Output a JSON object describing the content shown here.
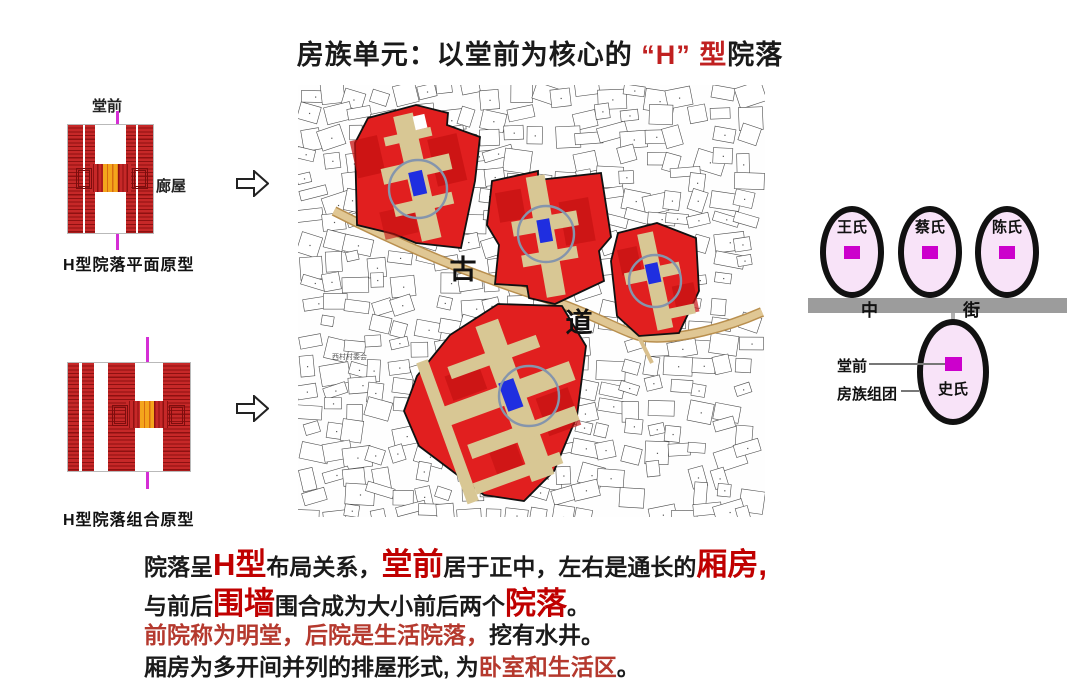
{
  "title": {
    "segments": [
      {
        "t": "房族单元：以堂前为核心的",
        "s": "base"
      },
      {
        "t": " “H” 型",
        "s": "tred"
      },
      {
        "t": "院落",
        "s": "base"
      }
    ]
  },
  "left_panel": {
    "hall_label": "堂前",
    "corridor_label": "廊屋",
    "caption_plan": "H型院落平面原型",
    "caption_combo": "H型院落组合原型"
  },
  "map": {
    "road_char_1": "古",
    "road_char_2": "道",
    "village_label": "西村村委会"
  },
  "right_panel": {
    "families_top": [
      "王氏",
      "蔡氏",
      "陈氏"
    ],
    "family_bottom": "史氏",
    "street_char_left": "中",
    "street_char_right": "街",
    "hall_pointer_label": "堂前",
    "cluster_pointer_label": "房族组团"
  },
  "body_text": {
    "line1": [
      {
        "t": "院落呈",
        "s": "base"
      },
      {
        "t": "H型",
        "s": "em"
      },
      {
        "t": "布局关系，",
        "s": "base"
      },
      {
        "t": "堂前",
        "s": "em"
      },
      {
        "t": "居于正中，左右是通长的",
        "s": "base"
      },
      {
        "t": "厢房,",
        "s": "em"
      }
    ],
    "line2": [
      {
        "t": "与前后",
        "s": "base"
      },
      {
        "t": "围墙",
        "s": "em"
      },
      {
        "t": "围合成为大小前后两个",
        "s": "base"
      },
      {
        "t": "院落",
        "s": "em"
      },
      {
        "t": "。",
        "s": "base"
      }
    ],
    "line3": [
      {
        "t": "前院称为明堂，后院是生活院落，",
        "s": "red"
      },
      {
        "t": "挖有水井。",
        "s": "base"
      }
    ],
    "line4": [
      {
        "t": "厢房为多开间并列的排屋形式, 为",
        "s": "base"
      },
      {
        "t": "卧室和生活区",
        "s": "red"
      },
      {
        "t": "。",
        "s": "base"
      }
    ]
  },
  "colors": {
    "accent_red": "#c00000",
    "title_red": "#c02020",
    "soft_red": "#b5392e",
    "cluster_red": "#e11f1f",
    "courtyard_tan": "#d8c794",
    "road_tan": "#e0c794",
    "hall_blue": "#1f2ee0",
    "axis_magenta": "#d52ed5",
    "roof_red": "#c62828",
    "roof_dark": "#8e1111",
    "center_orange": "#f4a51c",
    "ellipse_pink": "#f8e3f8",
    "marker_magenta": "#cc00cc",
    "street_gray": "#9c9c9c",
    "circle_stroke": "#8595ac"
  }
}
